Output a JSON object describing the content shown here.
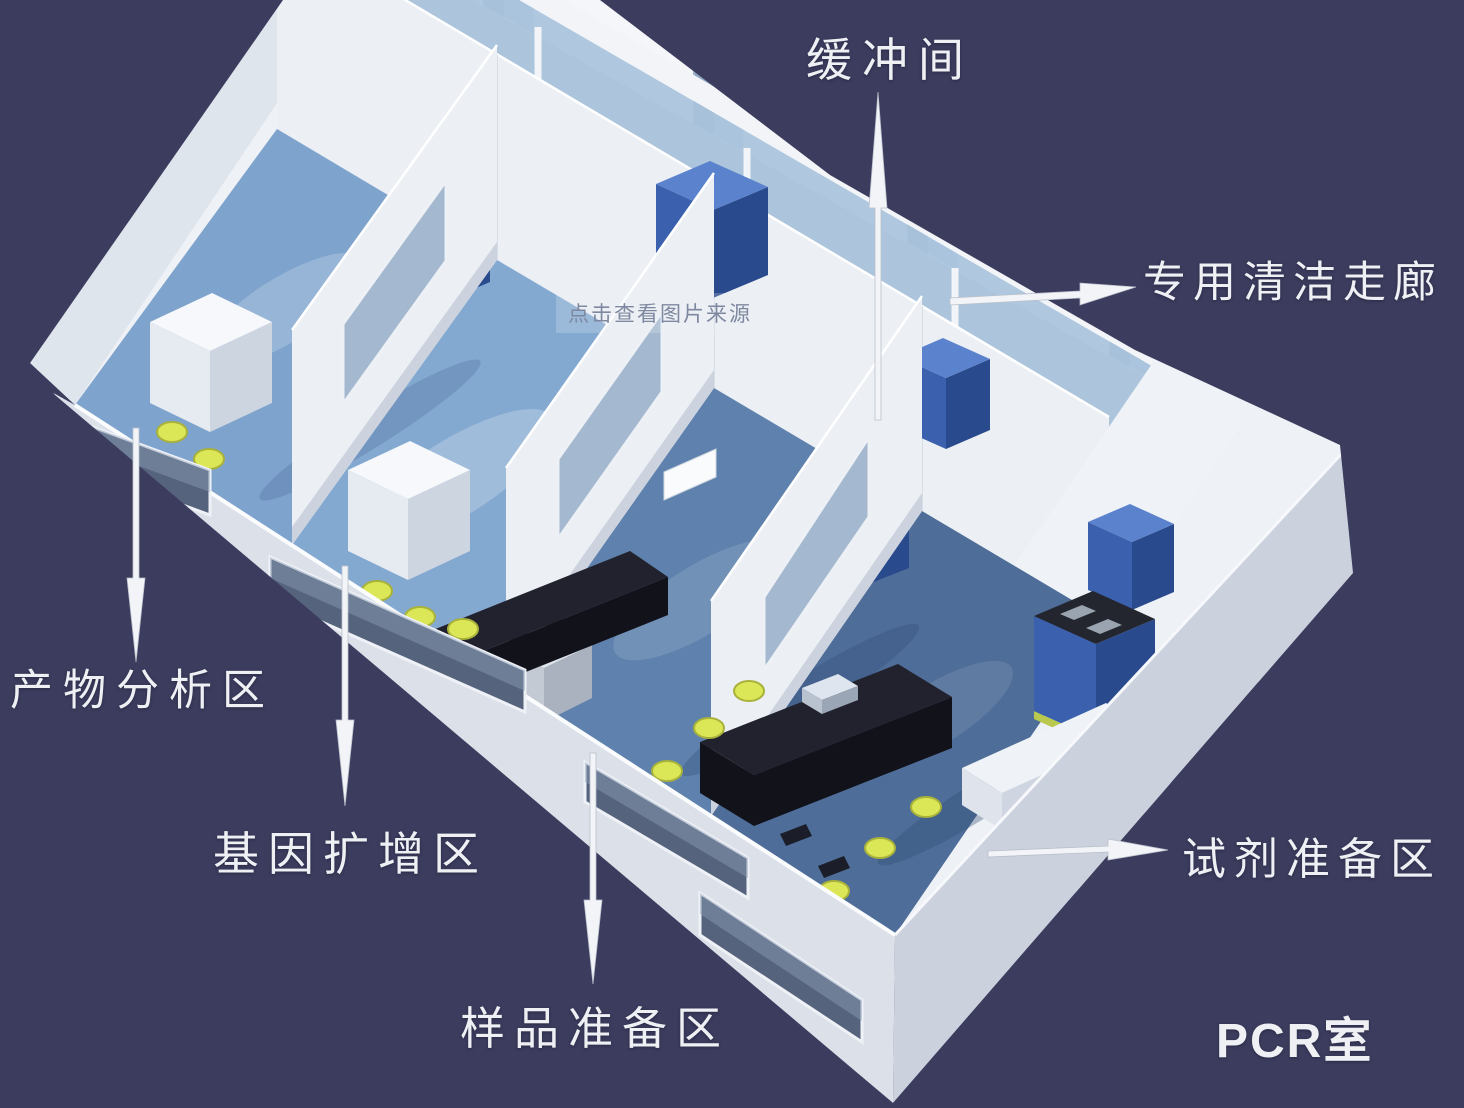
{
  "canvas": {
    "width": 1464,
    "height": 1108
  },
  "labels": {
    "buffer_room": "缓冲间",
    "clean_corridor": "专用清洁走廊",
    "product_analysis": "产物分析区",
    "gene_amplification": "基因扩增区",
    "sample_preparation": "样品准备区",
    "reagent_preparation": "试剂准备区",
    "pcr_room": "PCR室"
  },
  "watermark": {
    "text": "点击查看图片来源",
    "color": "#7e88a0"
  },
  "colors": {
    "background": "#3c3c5e",
    "interior_base": "#eef1f6",
    "wall_back": "#f4f6f9",
    "wall_inner": "#eceff4",
    "wall_top_strip": "#dfe5ec",
    "wall_outer_left": "#e7ebf1",
    "wall_outer_front": "#dce1e9",
    "wall_outer_right": "#cbd2de",
    "corridor_floor": "#c7d3e1",
    "buffer_floor": "#bccadb",
    "glass_blue": "#a9c3dc",
    "door_glass": "#b9cfe5",
    "partition_glass": "#9db4cc",
    "floor_room1": "#7ea3cd",
    "floor_room2": "#84a9d1",
    "floor_room3": "#5e82ad",
    "floor_room4": "#4e6d98",
    "cabinet_top": "#5b82cc",
    "cabinet_front": "#3a60ae",
    "cabinet_side": "#2a4a8e",
    "cabinet_dark_top": "#23262e",
    "cabinet_base_strip": "#b9c84e",
    "machine_top": "#f6f8fb",
    "machine_front": "#e6ebf1",
    "machine_side": "#cdd5e0",
    "bench_top": "#22222e",
    "bench_side": "#12121a",
    "stool_yellow": "#dce757",
    "stool_edge": "#a8b23a",
    "arrow": "#f2f4f7",
    "label_text": "#eef0f4"
  }
}
